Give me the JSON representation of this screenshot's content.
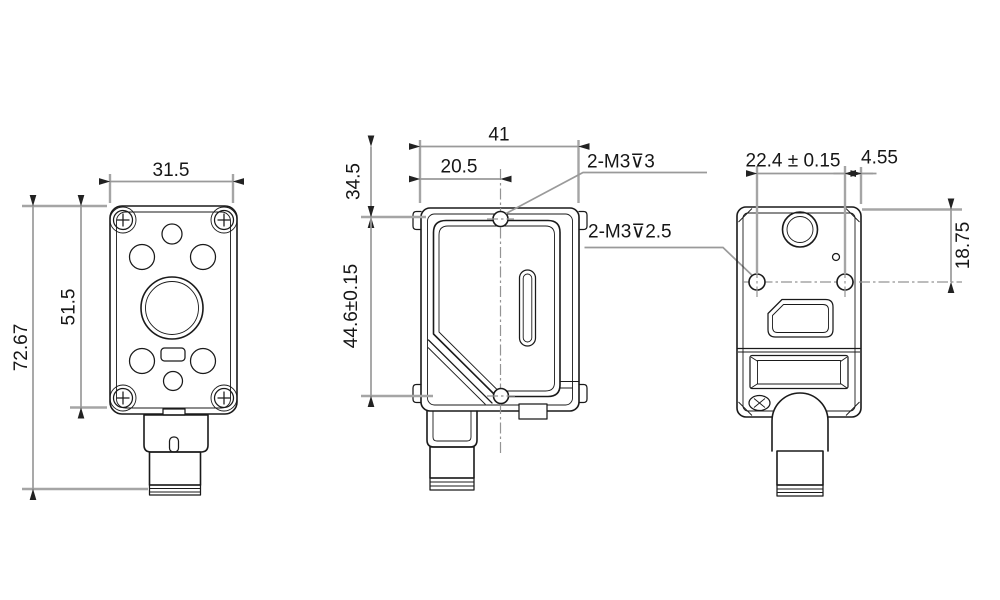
{
  "colors": {
    "background": "#ffffff",
    "outline": "#1a1a1a",
    "dimension_lines": "#9a9a9a",
    "text": "#161616"
  },
  "dims": {
    "front_width": "31.5",
    "front_panel_height": "51.5",
    "front_total_height": "72.67",
    "back_width": "41",
    "back_hole_offset": "20.5",
    "back_top_section": "34.5",
    "back_hole_spacing": "44.6±0.15",
    "side_hole_spacing": "22.4 ± 0.15",
    "side_hole_edge": "4.55",
    "side_top_to_hole": "18.75"
  },
  "callouts": {
    "back_holes": "2-M3⊽3",
    "side_holes": "2-M3⊽2.5"
  }
}
